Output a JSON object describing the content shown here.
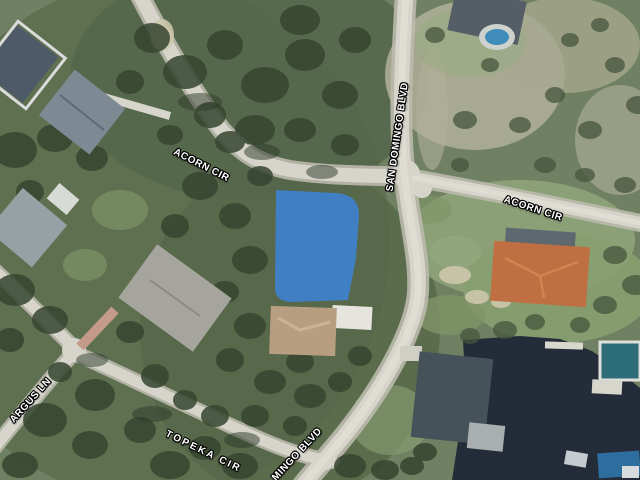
{
  "map": {
    "description": "Aerial parcel map with highlighted lot at Acorn Cir and San Domingo Blvd",
    "labels": {
      "san_domingo": "SAN DOMINGO BLVD",
      "acorn_left": "ACORN CIR",
      "acorn_right": "ACORN CIR",
      "topeka": "TOPEKA CIR",
      "argus": "ARGUS LN",
      "mingo": "MINGO BLVD"
    },
    "colors": {
      "parcel_highlight": "#3f81ce",
      "water": "#232c38",
      "road": "#d7d5cb",
      "forest": "#3a4935",
      "grass": "#7d8f6f"
    }
  }
}
